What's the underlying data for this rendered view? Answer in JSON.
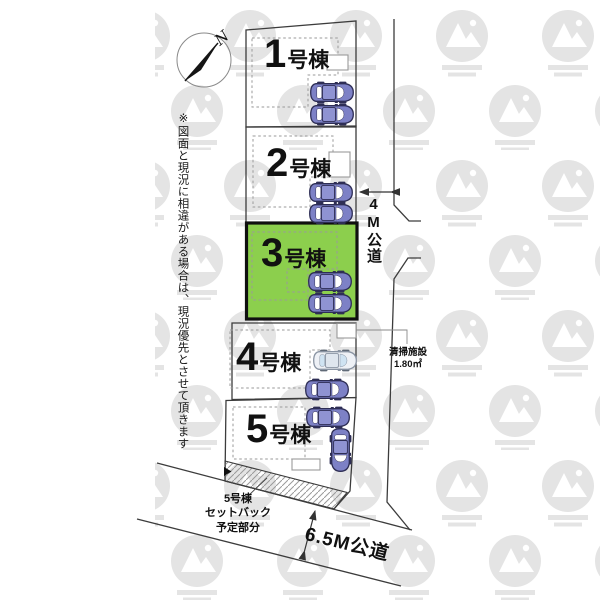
{
  "plan": {
    "compass_label": "N",
    "disclaimer": "※図面と現況に相違がある場合は、現況優先とさせて頂きます",
    "lots": [
      {
        "name": "1号棟",
        "number": "1",
        "suffix": "号棟",
        "highlighted": false,
        "cars": 2
      },
      {
        "name": "2号棟",
        "number": "2",
        "suffix": "号棟",
        "highlighted": false,
        "cars": 2
      },
      {
        "name": "3号棟",
        "number": "3",
        "suffix": "号棟",
        "highlighted": true,
        "cars": 2
      },
      {
        "name": "4号棟",
        "number": "4",
        "suffix": "号棟",
        "highlighted": false,
        "cars": 2
      },
      {
        "name": "5号棟",
        "number": "5",
        "suffix": "号棟",
        "highlighted": false,
        "cars": 2
      }
    ],
    "roads": [
      {
        "label": "4M公道",
        "orientation": "vertical"
      },
      {
        "label": "6.5M公道",
        "orientation": "diagonal"
      }
    ],
    "cleaning_facility": {
      "name": "清掃施設",
      "size": "1.80㎡"
    },
    "setback_note": {
      "line1": "5号棟",
      "line2": "セットバック",
      "line3": "予定部分"
    },
    "colors": {
      "highlight_green": "#8CCF4D",
      "lot_line": "#3C3C3C",
      "car_purple": "#7D81C6",
      "car_white": "#EEF1F6",
      "watermark_gray": "#E4E4E4"
    }
  }
}
